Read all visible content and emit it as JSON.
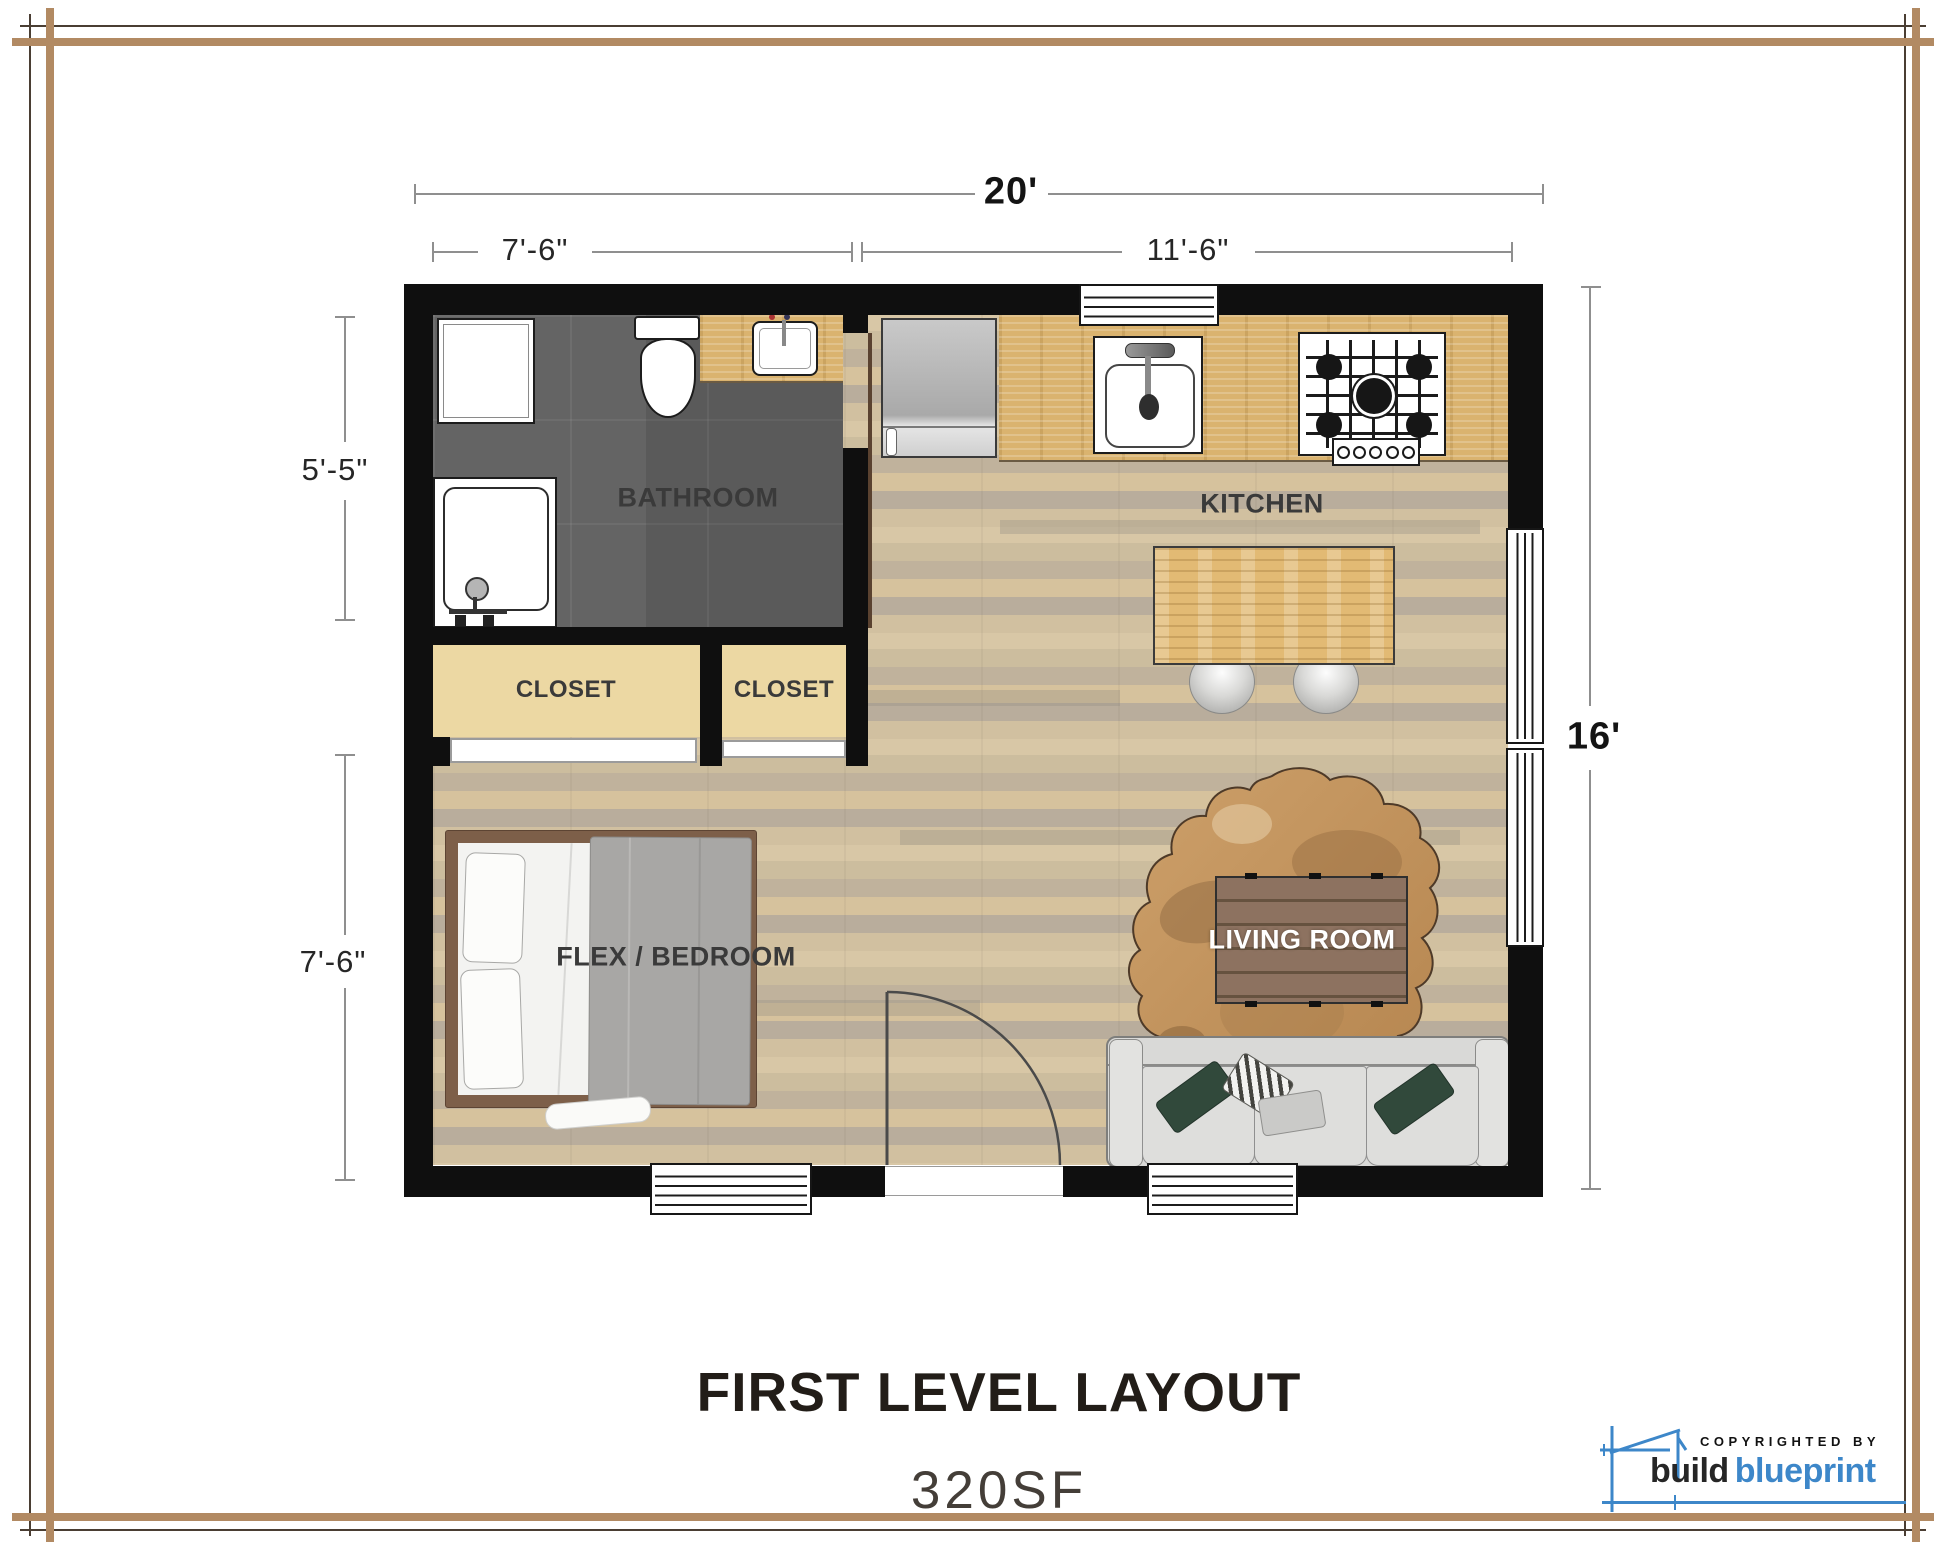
{
  "dimensions": {
    "overall_width": "20'",
    "width_left": "7'-6\"",
    "width_right": "11'-6\"",
    "overall_height": "16'",
    "bath_height": "5'-5\"",
    "bedroom_height": "7'-6\""
  },
  "rooms": {
    "bathroom": "BATHROOM",
    "kitchen": "KITCHEN",
    "closet_left": "CLOSET",
    "closet_right": "CLOSET",
    "flex_bedroom": "FLEX / BEDROOM",
    "living_room": "LIVING ROOM"
  },
  "title": {
    "heading": "FIRST LEVEL LAYOUT",
    "area": "320SF"
  },
  "branding": {
    "copyright": "COPYRIGHTED BY",
    "brand_word_dark": "build",
    "brand_word_blue": "blueprint"
  },
  "colors": {
    "wall": "#0f0f0f",
    "frame_tan": "#b28a63",
    "brand_blue": "#3d87c9",
    "tile_gray": "#9b9b9b",
    "wood_floor": "#d3c2a2",
    "counter_wood": "#dab36f",
    "closet_tan": "#ecd8a3"
  }
}
